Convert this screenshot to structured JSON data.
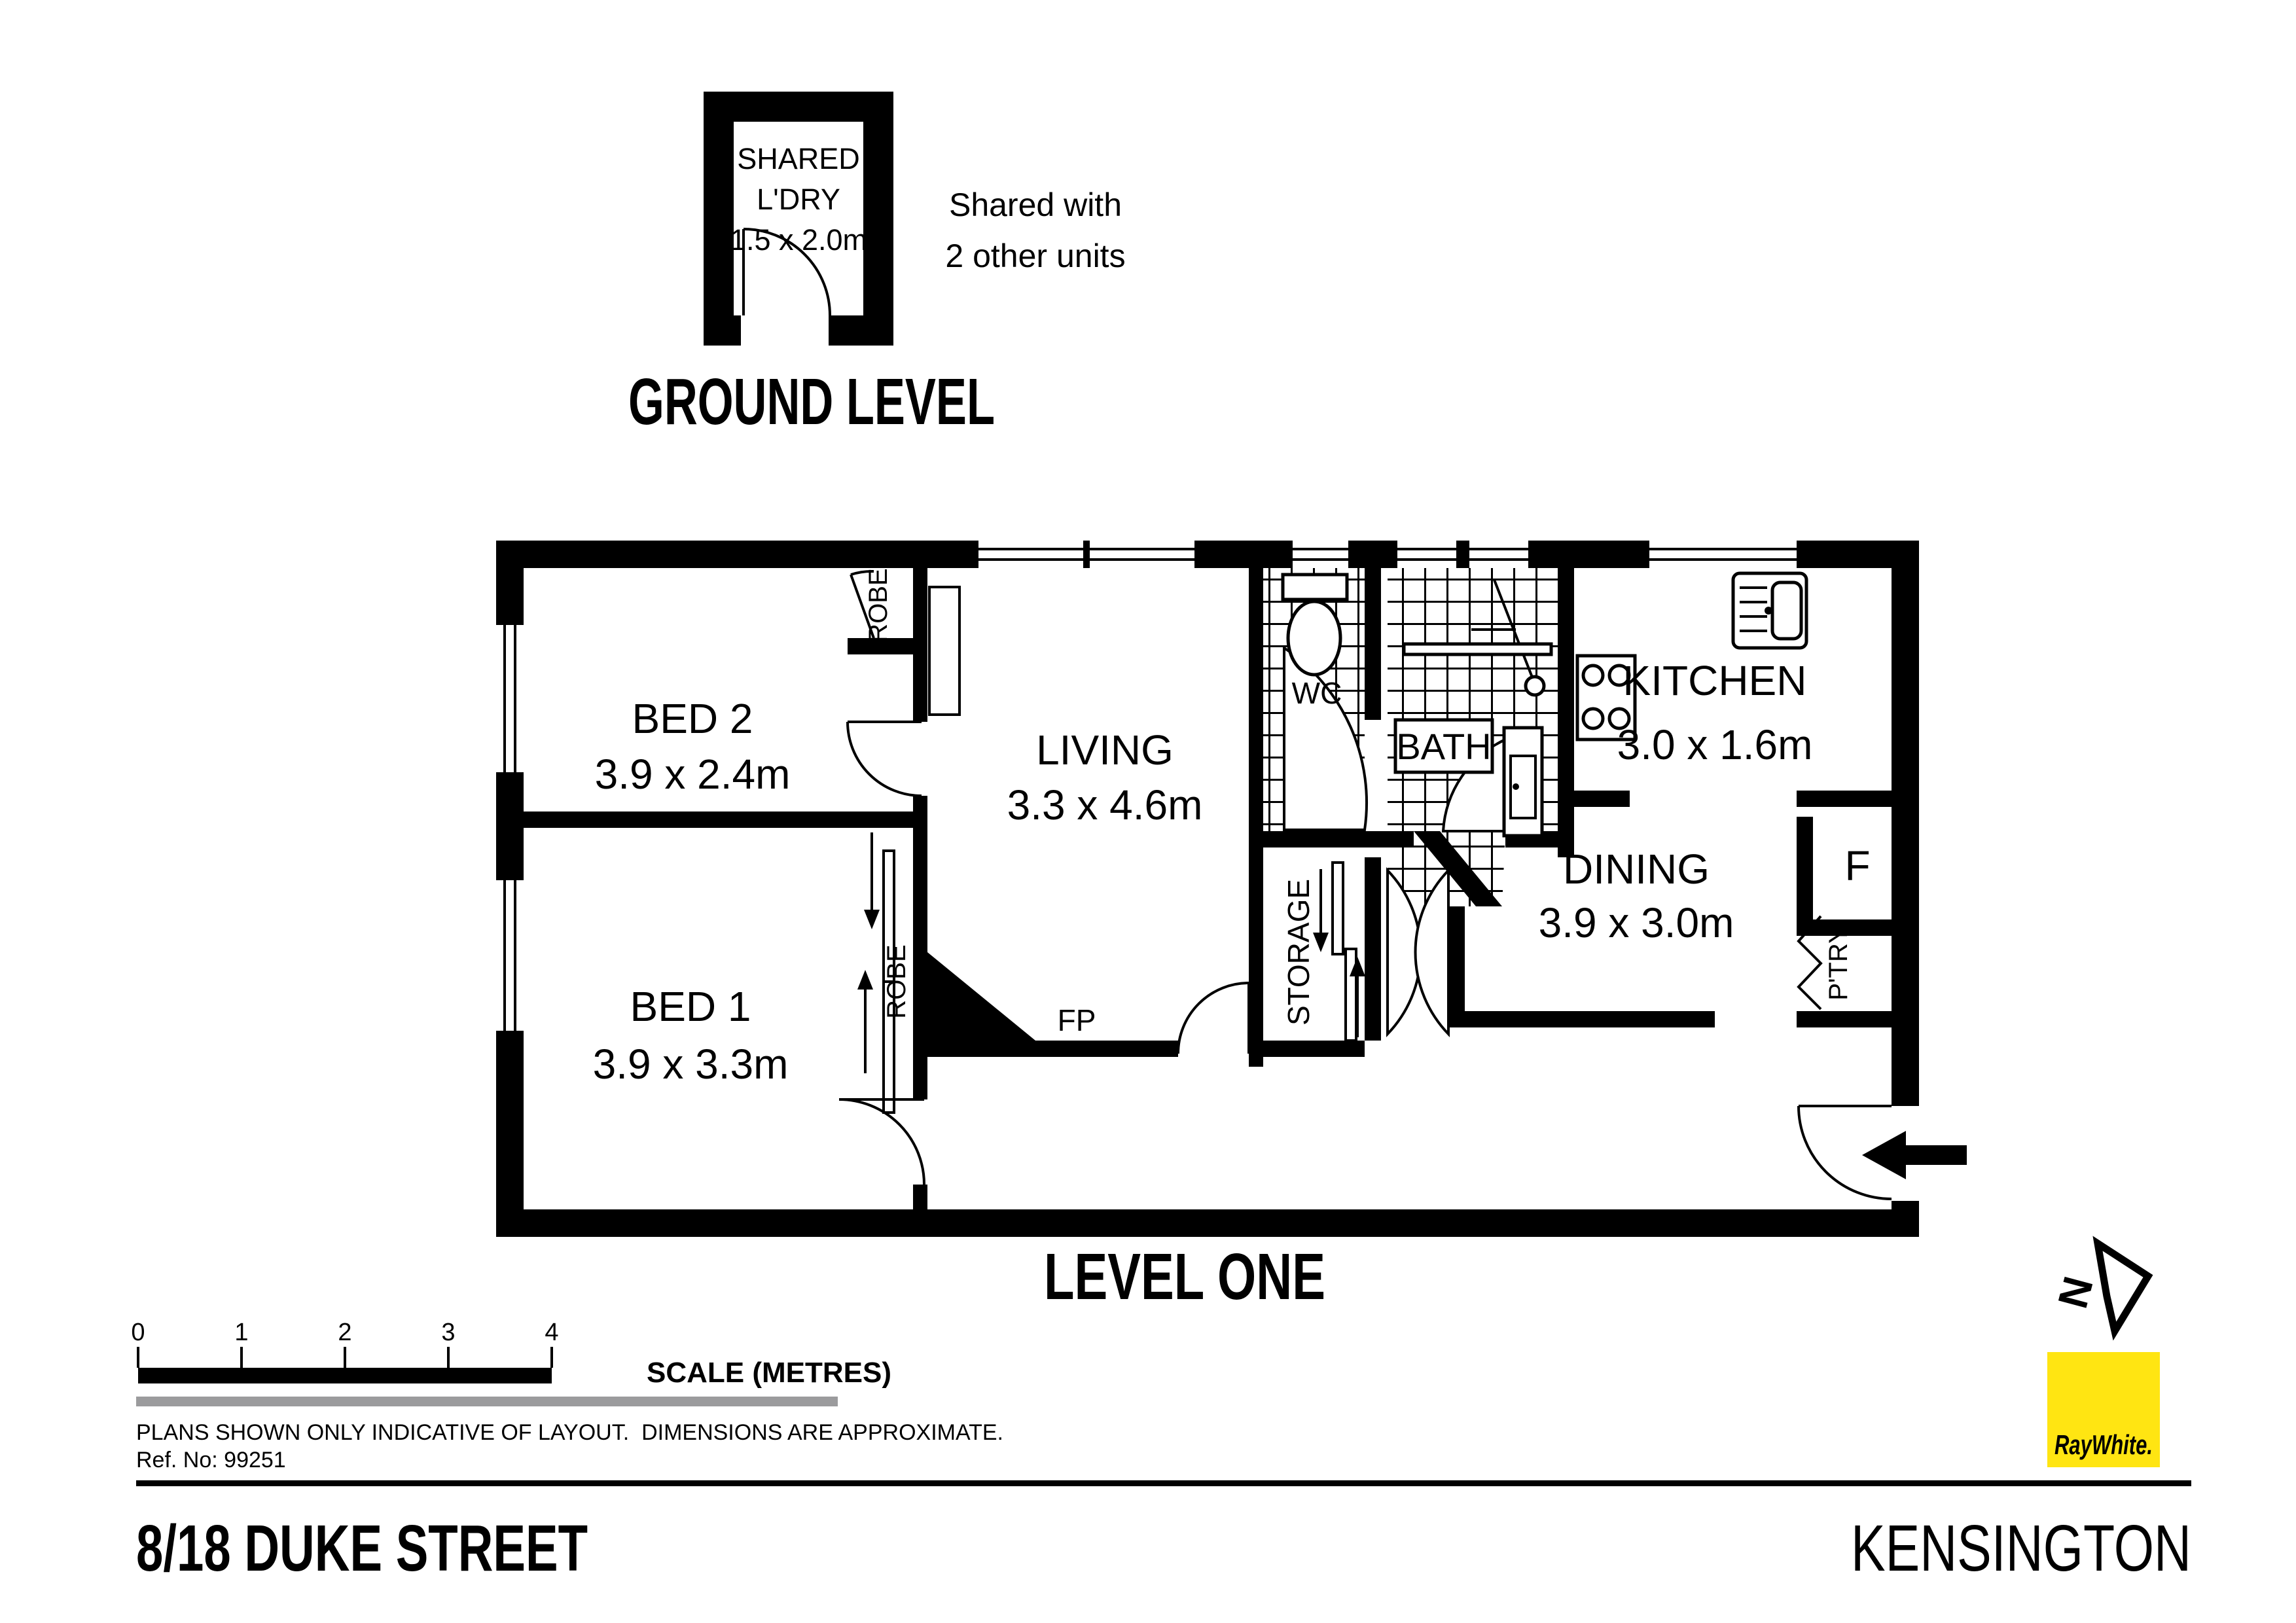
{
  "ground_level": {
    "title": "GROUND LEVEL",
    "laundry": {
      "line1": "SHARED",
      "line2": "L'DRY",
      "dims": "1.5 x 2.0m"
    },
    "note": {
      "line1": "Shared with",
      "line2": "2 other units"
    }
  },
  "level_one": {
    "title": "LEVEL ONE",
    "rooms": {
      "bed2": {
        "name": "BED 2",
        "dims": "3.9 x 2.4m"
      },
      "bed1": {
        "name": "BED 1",
        "dims": "3.9 x 3.3m"
      },
      "living": {
        "name": "LIVING",
        "dims": "3.3 x 4.6m"
      },
      "kitchen": {
        "name": "KITCHEN",
        "dims": "3.0 x 1.6m"
      },
      "dining": {
        "name": "DINING",
        "dims": "3.9 x 3.0m"
      },
      "wc": "WC",
      "bath": "BATH",
      "storage": "STORAGE",
      "robe_top": "ROBE",
      "robe_bed1": "ROBE",
      "fireplace": "FP",
      "fridge": "F",
      "pantry": "P'TRY"
    }
  },
  "scale_bar": {
    "ticks": [
      "0",
      "1",
      "2",
      "3",
      "4"
    ],
    "label": "SCALE (METRES)"
  },
  "notes": {
    "disclaimer": "PLANS SHOWN ONLY INDICATIVE OF LAYOUT.  DIMENSIONS ARE APPROXIMATE.",
    "reference": "Ref. No: 99251"
  },
  "footer": {
    "address": "8/18 DUKE STREET",
    "suburb": "KENSINGTON"
  },
  "north_indicator": "N",
  "brand": {
    "name": "RayWhite.",
    "square_color": "#FFE512",
    "text_color": "#54565A"
  }
}
